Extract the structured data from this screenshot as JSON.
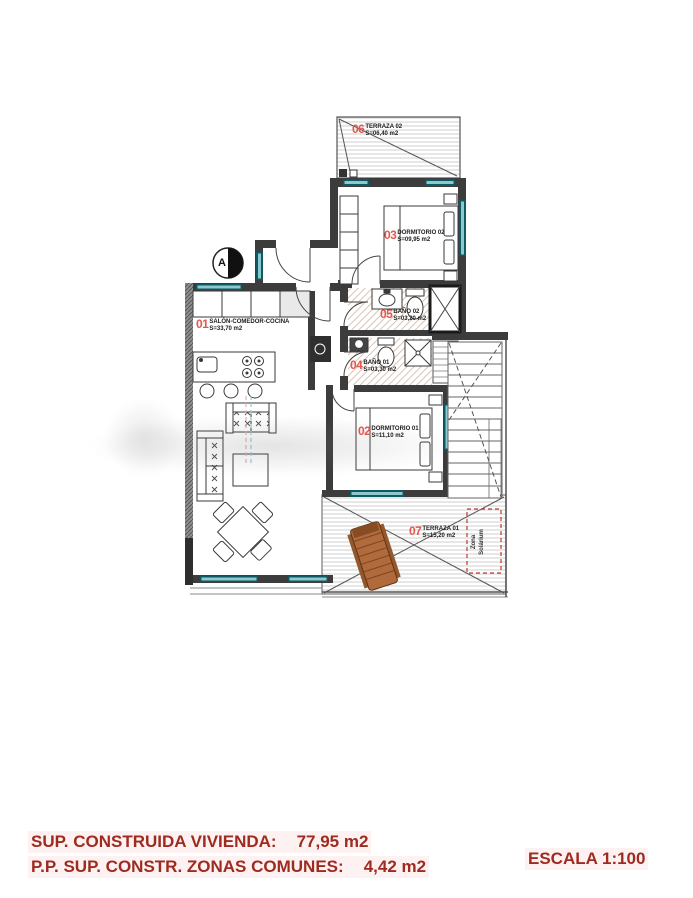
{
  "plan": {
    "section_marker": "A",
    "rooms": {
      "terrace2": {
        "num": "06",
        "name": "TERRAZA 02",
        "area": "S=06,40 m2"
      },
      "dorm2": {
        "num": "03",
        "name": "DORMITORIO 02",
        "area": "S=09,95 m2"
      },
      "bath2": {
        "num": "05",
        "name": "BAÑO 02",
        "area": "S=03,20 m2"
      },
      "bath1": {
        "num": "04",
        "name": "BAÑO 01",
        "area": "S=03,30 m2"
      },
      "salon": {
        "num": "01",
        "name": "SALÓN-COMEDOR-COCINA",
        "area": "S=33,70 m2"
      },
      "dorm1": {
        "num": "02",
        "name": "DORMITORIO 01",
        "area": "S=11,10 m2"
      },
      "terrace1": {
        "num": "07",
        "name": "TERRAZA 01",
        "area": "S=15,20 m2"
      }
    },
    "zona_label": {
      "line1": "Zona",
      "line2": "Solárium"
    }
  },
  "footer": {
    "line1_label": "SUP. CONSTRUIDA VIVIENDA:",
    "line1_value": "77,95 m2",
    "line2_label": "P.P. SUP. CONSTR. ZONAS COMUNES:",
    "line2_value": "4,42 m2",
    "scale": "ESCALA 1:100"
  },
  "colors": {
    "footer_red": "#9e2b20",
    "room_number_red": "#e2574d",
    "window_teal": "#0e5a62",
    "wall_dark": "#3c3c3c",
    "lounger_wood": "#b06a3b",
    "dashed_zone_red": "#c0392b"
  }
}
